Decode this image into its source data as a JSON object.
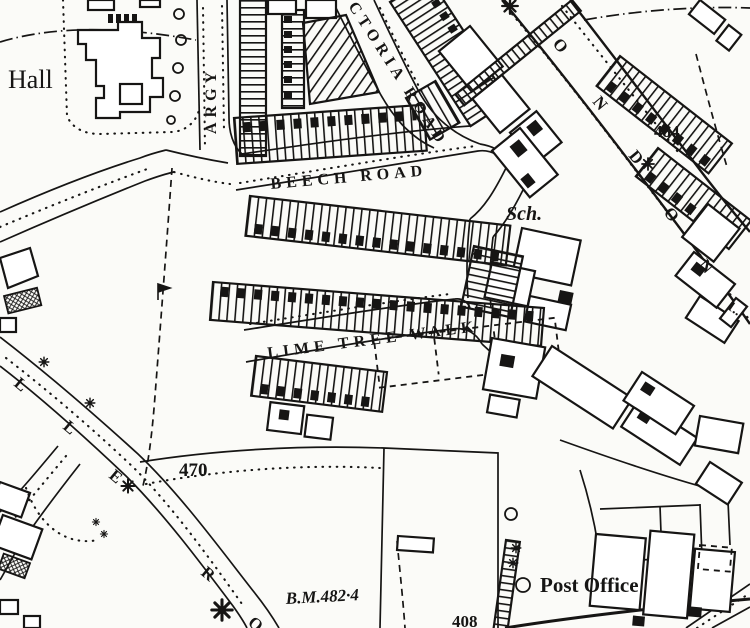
{
  "map": {
    "kind": "historic ordnance survey town plan extract",
    "ink_color": "#161514",
    "paper_color": "#fbfbf8",
    "places": {
      "hall": "Hall",
      "school": "Sch.",
      "post_office": "Post Office"
    },
    "streets": {
      "beech_road": "BEECH ROAD",
      "lime_tree_walk": "LIME TREE WALK",
      "victoria_road_partial": "CTORIA ROAD",
      "argyle_partial": "ARGY",
      "london_letters": [
        "O",
        "N",
        "D",
        "O",
        "N"
      ],
      "west_road_letters": [
        "L",
        "L",
        "E",
        "R",
        "O"
      ]
    },
    "elevations": {
      "spot_484": "484",
      "spot_470": "470",
      "benchmark": "B.M.482·4",
      "spot_408": "408",
      "partial_right_edge": "1.."
    }
  }
}
